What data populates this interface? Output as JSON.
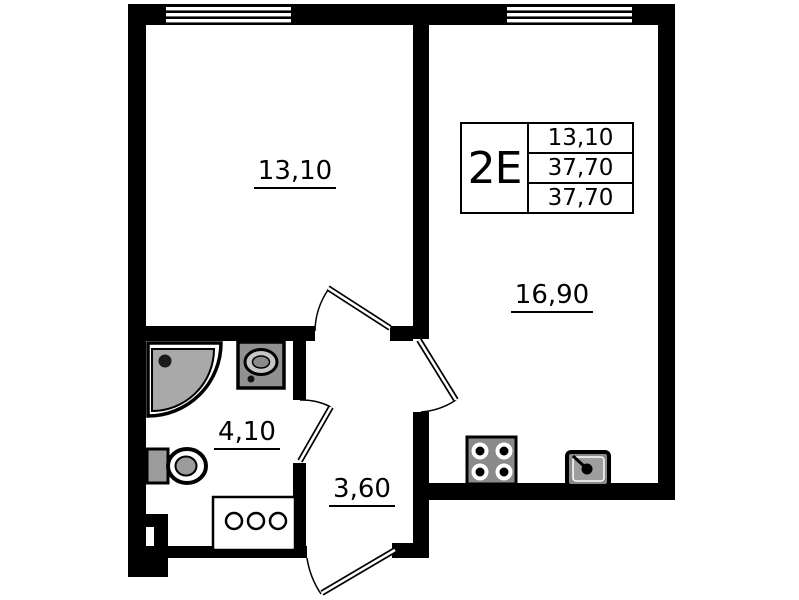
{
  "legend": {
    "unit_code": "2E",
    "areas": [
      "13,10",
      "37,70",
      "37,70"
    ]
  },
  "rooms": {
    "bedroom": {
      "area": "13,10"
    },
    "living_room": {
      "area": "16,90"
    },
    "bathroom": {
      "area": "4,10"
    },
    "hallway": {
      "area": "3,60"
    }
  },
  "fixtures": [
    "corner-shower",
    "washbasin",
    "toilet",
    "drawer-cabinet",
    "stove-4-burner",
    "kitchen-sink"
  ],
  "features": {
    "windows": 2,
    "doors": 4
  },
  "colors": {
    "walls": "#000000",
    "fixture_gray": "#9a9a9a",
    "shower_gray": "#a9a9a9",
    "background": "#ffffff"
  }
}
